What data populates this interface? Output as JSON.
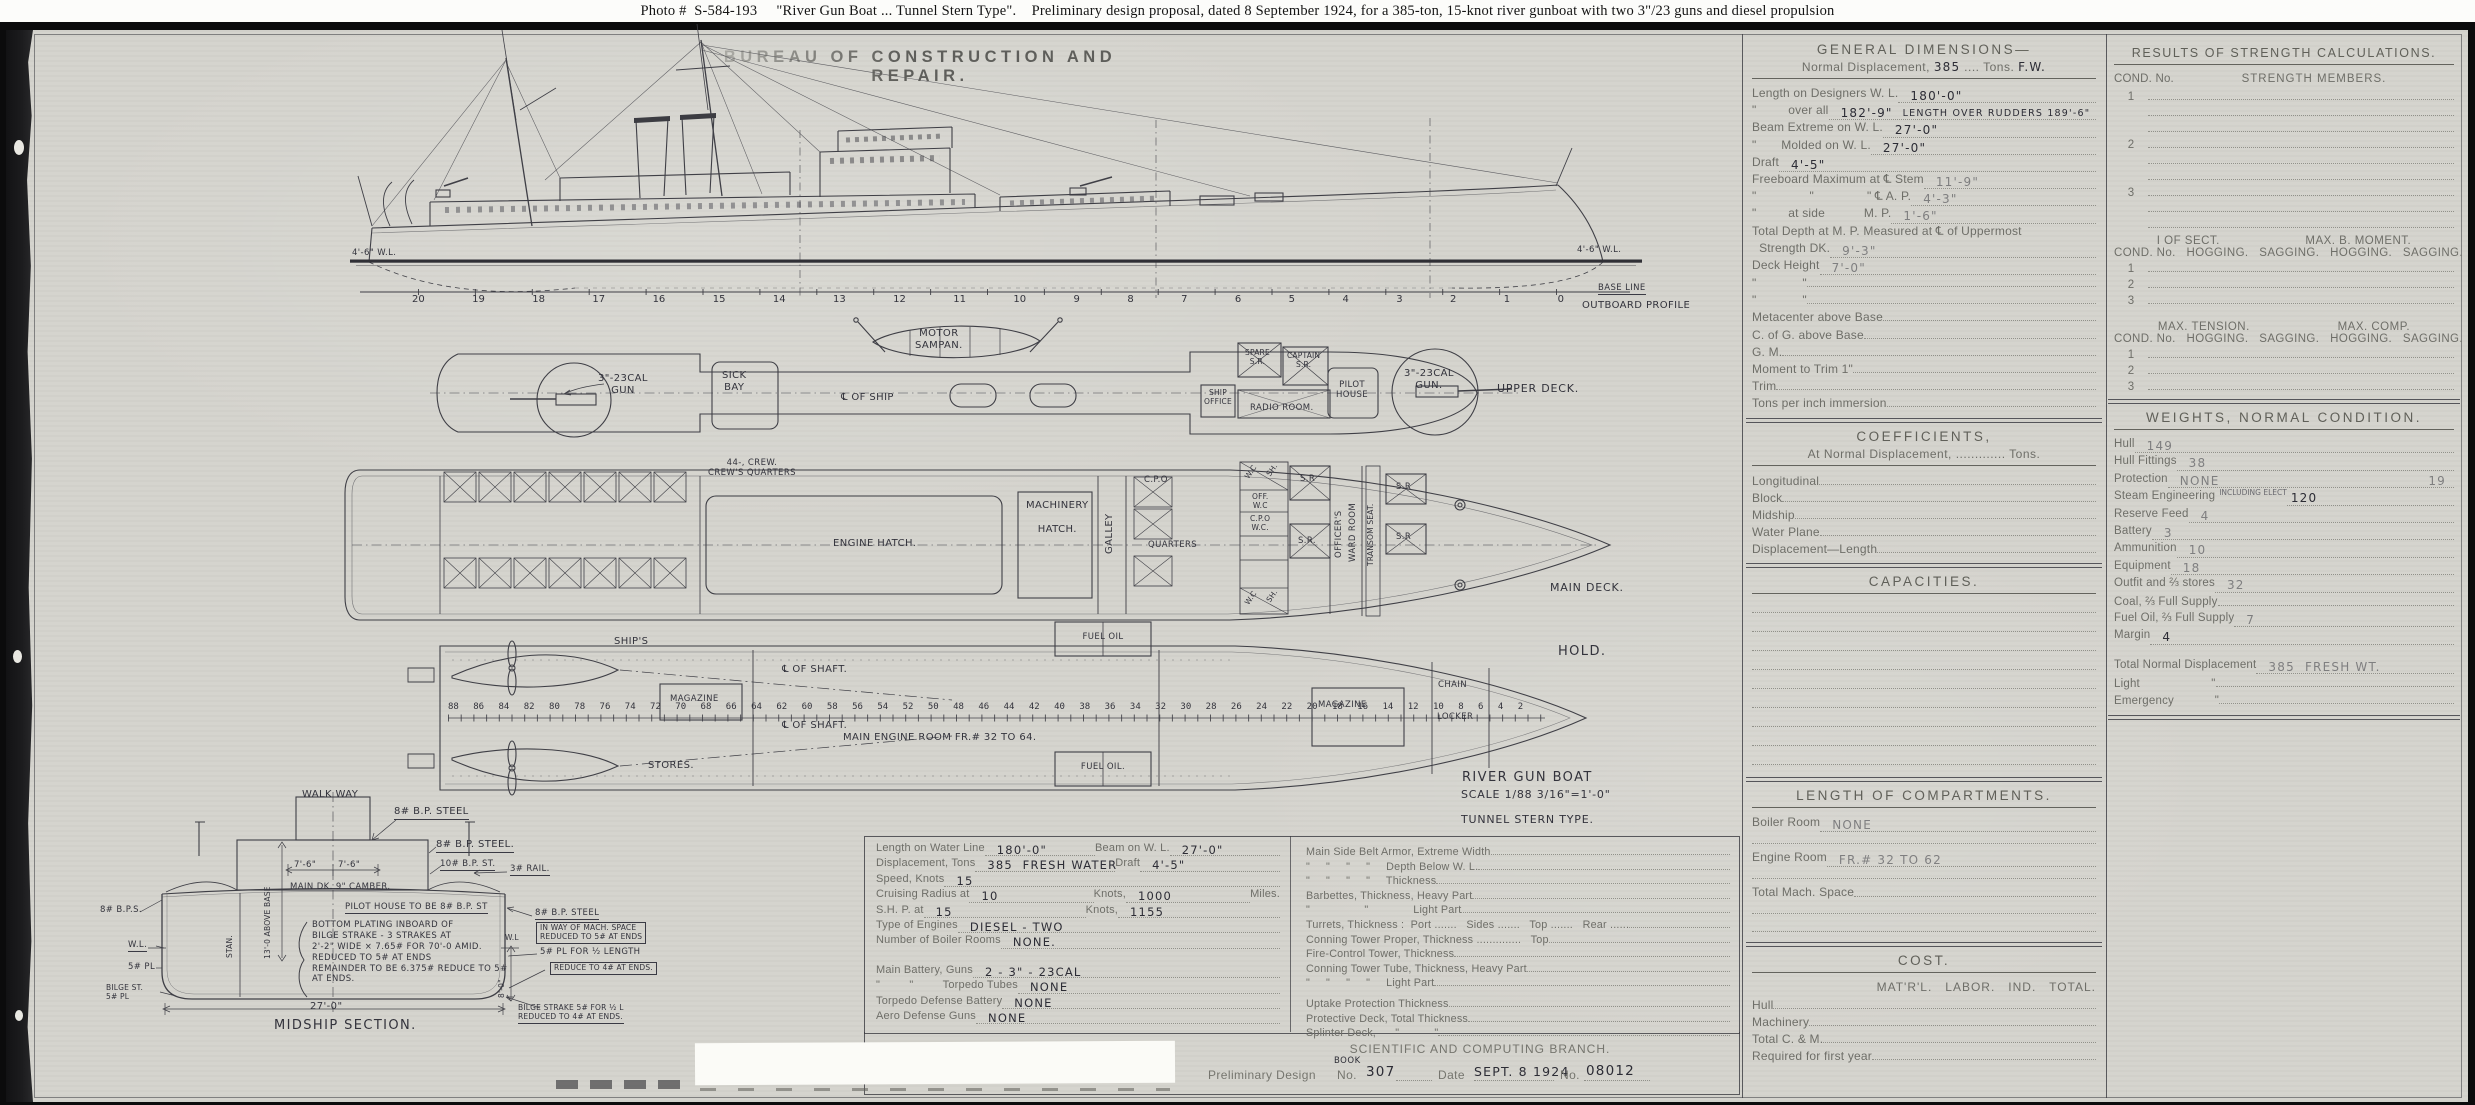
{
  "caption": "Photo #  S-584-193     \"River Gun Boat ... Tunnel Stern Type\".    Preliminary design proposal, dated 8 September 1924, for a 385-ton, 15-knot river gunboat with two 3\"/23 guns and diesel propulsion",
  "bureau_title": "BUREAU OF CONSTRUCTION AND REPAIR.",
  "profile": {
    "wl_left": "4'-6\" W.L.",
    "wl_right": "4'-6\" W.L.",
    "baseline": "BASE LINE",
    "view": "OUTBOARD PROFILE",
    "st": [
      "20",
      "19",
      "18",
      "17",
      "16",
      "15",
      "14",
      "13",
      "12",
      "11",
      "10",
      "9",
      "8",
      "7",
      "6",
      "5",
      "4",
      "3",
      "2",
      "1",
      "0"
    ]
  },
  "upper": {
    "gun_aft": "3\"-23CAL\nGUN",
    "sick_bay": "SICK\nBAY",
    "sampan": "MOTOR\nSAMPAN.",
    "cl_ship": "℄ OF SHIP",
    "ship_office": "SHIP\nOFFICE",
    "spare_sr": "SPARE\nS.R.",
    "captain_sr": "CAPTAIN\nS.R.",
    "radio": "RADIO ROOM.",
    "pilot": "PILOT\nHOUSE",
    "gun_fwd": "3\"-23CAL\nGUN.",
    "deck": "UPPER DECK."
  },
  "main": {
    "crew": "44-, CREW.\nCREW'S QUARTERS",
    "engine_hatch": "ENGINE HATCH.",
    "mach_hatch": "MACHINERY\n\nHATCH.",
    "galley": "GALLEY",
    "cpo": "C.P.O",
    "quarters": "QUARTERS",
    "wc": "W.C",
    "sh": "SH.",
    "off_wc": "OFF.\nW.C",
    "cpo_wc": "C.P.O\nW.C.",
    "sr": "S.R",
    "sr_dot": "S.R.",
    "officers": "OFFICER'S",
    "wardroom": "WARD ROOM",
    "transom": "TRANSOM SEAT.",
    "deck": "MAIN DECK."
  },
  "hold": {
    "ships": "SHIP'S",
    "magazine_l": "MAGAZINE",
    "shaft": "℄ OF SHAFT.",
    "frames": "88 86 84 82 80 78 76 74 72 70 68 66 64 62 60 58 56 54 52 50 48 46 44 42 40 38 36 34 32 30 28 26 24 22 20 18 16 14 12 10 8 6 4 2",
    "engine_room": "MAIN ENGINE ROOM FR.# 32 TO 64.",
    "fuel_top": "FUEL   OIL",
    "fuel_bot": "FUEL   OIL.",
    "stores": "STORES.",
    "magazine_r": "MAGAZINE",
    "chain": "CHAIN",
    "locker": "LOCKER",
    "hold": "HOLD."
  },
  "title_block": {
    "name": "RIVER GUN BOAT",
    "scale": "SCALE 1/88  3/16\"=1'-0\"",
    "type": "TUNNEL STERN TYPE."
  },
  "midship": {
    "walkway": "WALK WAY",
    "bp8_top": "8# B.P. STEEL",
    "bp8_side": "8# B.P. STEEL.",
    "bp10": "10# B.P. ST.",
    "rail": "3# RAIL.",
    "d76": "7'-6\"",
    "camber": "MAIN DK. 9\" CAMBER.",
    "above_base": "13'-0 ABOVE BASE",
    "stan": "STAN.",
    "pilot_note": "PILOT HOUSE TO BE 8# B.P. ST",
    "bps_left": "8# B.P.S.",
    "wl": "W.L.",
    "pl5": "5# PL",
    "bilge_left": "BILGE ST.\n5# PL",
    "bottom_note": "BOTTOM PLATING INBOARD OF\nBILGE STRAKE - 3 STRAKES AT\n2'-2\" WIDE × 7.65# FOR 70'-0 AMID.\nREDUCED TO 5# AT ENDS\nREMAINDER TO BE 6.375# REDUCE TO 5#\nAT ENDS.",
    "w27": "27'-0\"",
    "caption": "MIDSHIP SECTION.",
    "r1": "8# B.P. STEEL",
    "r1b": "IN WAY OF MACH. SPACE\nREDUCED TO 5# AT ENDS",
    "r2": "5# PL FOR ½ LENGTH",
    "r3": "REDUCE TO 4# AT ENDS.",
    "wl_r": "W.L",
    "h80": "8'-0\"",
    "bilge_right": "BILGE STRAKE 5# FOR ½ L\nREDUCED TO 4# AT ENDS."
  },
  "spec": {
    "rows": [
      {
        "l": "Length on Water Line",
        "v": "180'-0\"",
        "l2": "Beam on W. L.",
        "v2": "27'-0\""
      },
      {
        "l": "Displacement, Tons",
        "v": "385  FRESH WATER",
        "l2": "Draft",
        "v2": "4'-5\""
      },
      {
        "l": "Speed, Knots",
        "v": "15"
      },
      {
        "l": "Cruising Radius at",
        "v": "10",
        "l2": "Knots,",
        "v2": "1000",
        "l3": "Miles."
      },
      {
        "l": "S.H. P. at",
        "v": "15",
        "l2": "Knots,",
        "v2": "1155"
      },
      {
        "l": "Type of Engines",
        "v": "DIESEL - TWO"
      },
      {
        "l": "Number of Boiler Rooms",
        "v": "NONE."
      },
      {
        "l": "Main Battery, Guns",
        "v": "2 - 3\" - 23CAL"
      },
      {
        "l": "\"         \"         Torpedo Tubes",
        "v": "NONE"
      },
      {
        "l": "Torpedo Defense Battery",
        "v": "NONE"
      },
      {
        "l": "Aero Defense Guns",
        "v": "NONE"
      }
    ]
  },
  "armor": {
    "rows": [
      "Main Side Belt Armor, Extreme Width",
      "\"     \"     \"     \"     Depth Below W. L.",
      "\"     \"     \"     \"     Thickness",
      "Barbettes, Thickness, Heavy Part",
      "\"                 \"              Light Part",
      "Turrets, Thickness :  Port .......   Sides .......   Top .......   Rear ......",
      "Conning Tower Proper, Thickness ..............   Top",
      "Fire-Control Tower, Thickness",
      "Conning Tower Tube, Thickness, Heavy Part",
      "\"     \"     \"     \"     Light Part",
      "Uptake Protection Thickness",
      "Protective Deck, Total Thickness",
      "Splinter Deck,      \"           \""
    ]
  },
  "stamp": {
    "branch": "SCIENTIFIC AND COMPUTING BRANCH.",
    "book": "BOOK",
    "prelim": "Preliminary Design",
    "no_label": "No.",
    "design_no": "307",
    "date_label": "Date",
    "date": "SEPT. 8 1924",
    "serial_label": "No.",
    "serial": "08012"
  },
  "gd": {
    "title": "GENERAL DIMENSIONS—",
    "sub_l": "Normal Displacement,",
    "sub_v": "385",
    "sub_m": "Tons.",
    "sub_v2": "F.W.",
    "rows": [
      {
        "l": "Length on Designers W. L.",
        "v": "180'-0\""
      },
      {
        "l": "\"         over all",
        "v": "182'-9\"",
        "v2": "LENGTH OVER RUDDERS 189'-6\""
      },
      {
        "l": "Beam Extreme on W. L.",
        "v": "27'-0\""
      },
      {
        "l": "\"       Molded on W. L.",
        "v": "27'-0\""
      },
      {
        "l": "Draft",
        "v": "4'-5\""
      },
      {
        "l": "Freeboard Maximum at ℄ Stem",
        "v": "11'-9\""
      },
      {
        "l": "\"               \"               \" ℄ A. P.",
        "v": "4'-3\""
      },
      {
        "l": "\"         at side           M. P.",
        "v": "1'-6\""
      },
      {
        "l": "Total Depth at M. P. Measured at ℄ of Uppermost"
      },
      {
        "l": "  Strength DK.",
        "v": "9'-3\""
      },
      {
        "l": "Deck Height",
        "v": "7'-0\""
      },
      {
        "l": "\"             \""
      },
      {
        "l": "\"             \""
      },
      {
        "l": "Metacenter above Base"
      },
      {
        "l": "C. of G. above Base"
      },
      {
        "l": "G. M."
      },
      {
        "l": "Moment to Trim 1\""
      },
      {
        "l": "Trim"
      },
      {
        "l": "Tons per inch immersion"
      }
    ]
  },
  "coeff": {
    "title": "COEFFICIENTS,",
    "sub": "At Normal Displacement, ............. Tons.",
    "rows": [
      "Longitudinal",
      "Block",
      "Midship",
      "Water Plane",
      "Displacement—Length"
    ]
  },
  "cap": {
    "title": "CAPACITIES."
  },
  "loc": {
    "title": "LENGTH OF COMPARTMENTS.",
    "rows": [
      {
        "l": "Boiler Room",
        "v": "NONE"
      },
      {
        "l": "Engine Room",
        "v": "FR.# 32 TO 62"
      },
      {
        "l": "Total Mach. Space",
        "v": ""
      }
    ]
  },
  "cost": {
    "title": "COST.",
    "cols": "MAT'R'L.   LABOR.   IND.   TOTAL.",
    "rows": [
      "Hull",
      "Machinery",
      "Total C. & M.",
      "Required for first year"
    ]
  },
  "strength": {
    "title": "RESULTS OF STRENGTH CALCULATIONS.",
    "h_cond": "COND. No.",
    "h_members": "STRENGTH MEMBERS.",
    "n1": "1",
    "n2": "2",
    "n3": "3",
    "h_sect": "I OF SECT.",
    "h_moment": "MAX. B. MOMENT.",
    "h_cols": "COND. No.   HOGGING.   SAGGING.   HOGGING.   SAGGING.",
    "h_tension": "MAX. TENSION.",
    "h_comp": "MAX. COMP."
  },
  "weights": {
    "title": "WEIGHTS, NORMAL CONDITION.",
    "rows": [
      {
        "l": "Hull",
        "v": "149"
      },
      {
        "l": "Hull Fittings",
        "v": "38"
      },
      {
        "l": "Protection",
        "v": "NONE",
        "v2": "19"
      },
      {
        "l": "Steam Engineering",
        "ins": "INCLUDING ELECT",
        "v": "120"
      },
      {
        "l": "Reserve Feed",
        "v": "4"
      },
      {
        "l": "Battery",
        "v": "3"
      },
      {
        "l": "Ammunition",
        "v": "10"
      },
      {
        "l": "Equipment",
        "v": "18"
      },
      {
        "l": "Outfit and ⅔ stores",
        "v": "32"
      },
      {
        "l": "Coal, ⅔ Full Supply",
        "v": ""
      },
      {
        "l": "Fuel Oil, ⅔ Full Supply",
        "v": "7"
      },
      {
        "l": "Margin",
        "v": "4"
      },
      {
        "l": "Total Normal Displacement",
        "v": "385  FRESH WT."
      },
      {
        "l": "Light                     \"",
        "v": ""
      },
      {
        "l": "Emergency            \"",
        "v": ""
      }
    ]
  }
}
